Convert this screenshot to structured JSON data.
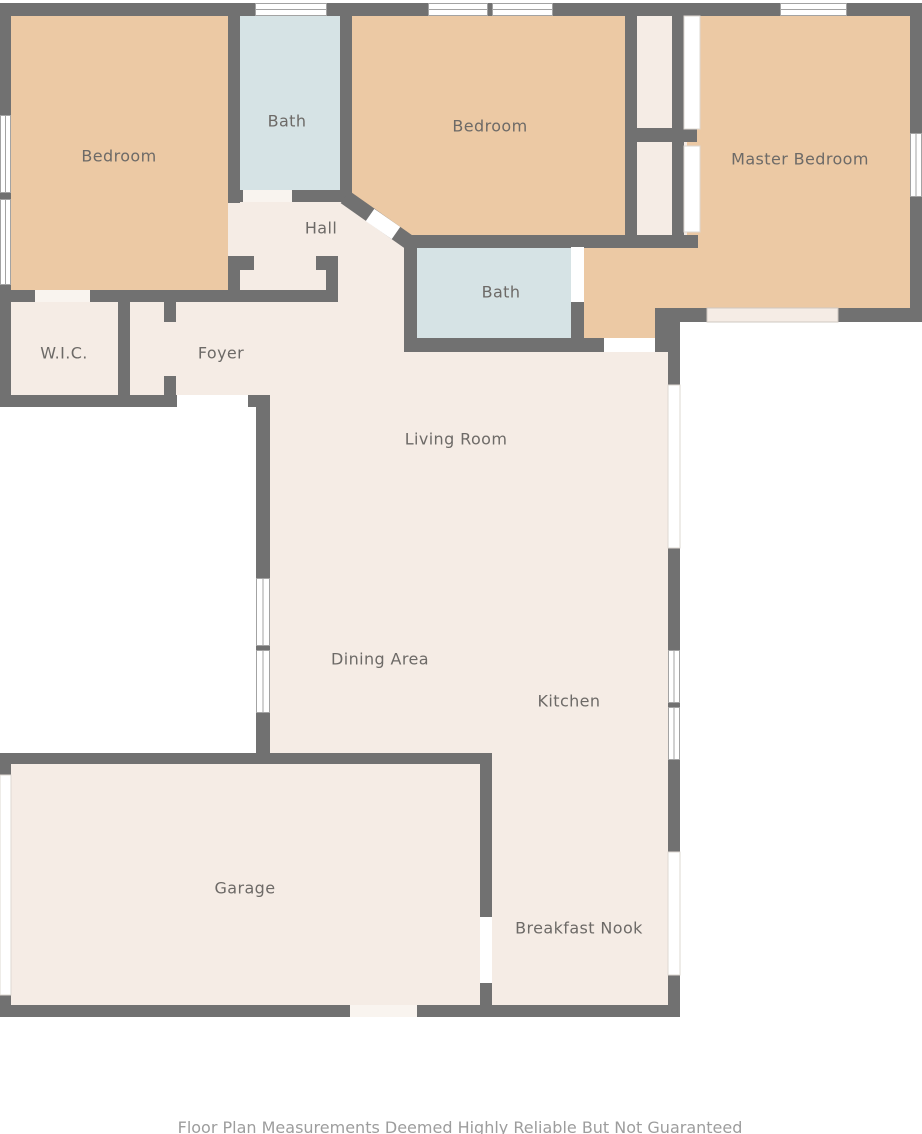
{
  "floor_plan": {
    "rooms": [
      {
        "id": "bedroom-1",
        "label": "Bedroom"
      },
      {
        "id": "bath-1",
        "label": "Bath"
      },
      {
        "id": "bedroom-2",
        "label": "Bedroom"
      },
      {
        "id": "master-bedroom",
        "label": "Master Bedroom"
      },
      {
        "id": "hall",
        "label": "Hall"
      },
      {
        "id": "wic",
        "label": "W.I.C."
      },
      {
        "id": "foyer",
        "label": "Foyer"
      },
      {
        "id": "bath-2",
        "label": "Bath"
      },
      {
        "id": "living-room",
        "label": "Living Room"
      },
      {
        "id": "dining-area",
        "label": "Dining Area"
      },
      {
        "id": "kitchen",
        "label": "Kitchen"
      },
      {
        "id": "garage",
        "label": "Garage"
      },
      {
        "id": "breakfast-nook",
        "label": "Breakfast Nook"
      }
    ],
    "disclaimer": "Floor Plan Measurements Deemed Highly Reliable But Not Guaranteed",
    "colors": {
      "wall": "#717171",
      "bedroom_fill": "#ecc9a4",
      "bath_fill": "#d6e3e5",
      "room_fill": "#f5ece5",
      "window_fill": "#ffffff",
      "label_text": "#6d6a67",
      "disclaimer_text": "#9d9d9d",
      "background": "#ffffff"
    }
  }
}
